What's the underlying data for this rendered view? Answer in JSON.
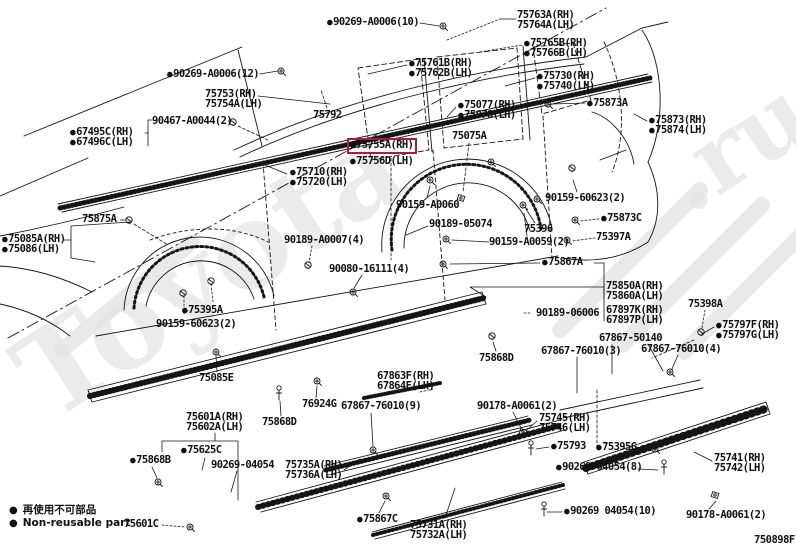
{
  "figure_code": "750898F",
  "colors": {
    "accent_highlight_box": "#a81c3c",
    "line_art": "#151515",
    "watermark": "#e0e0e0"
  },
  "icons": {
    "bullet": "●"
  },
  "watermark": {
    "brand": "Toyota",
    "suffix": ".ru"
  },
  "legend": {
    "jp": "再使用不可部品",
    "en": "Non-reusable part"
  },
  "highlighted_part": "75755A(RH)",
  "labels": [
    {
      "t": "90269-A0006(10)",
      "x": 327,
      "y": 17,
      "b": true
    },
    {
      "t": "90269-A0006(12)",
      "x": 167,
      "y": 69,
      "b": true
    },
    {
      "t": "75753(RH)",
      "x": 205,
      "y": 89,
      "b": false
    },
    {
      "t": "75754A(LH)",
      "x": 205,
      "y": 99,
      "b": false
    },
    {
      "t": "90467-A0044(2)",
      "x": 152,
      "y": 116,
      "b": false
    },
    {
      "t": "67495C(RH)",
      "x": 70,
      "y": 127,
      "b": true
    },
    {
      "t": "67496C(LH)",
      "x": 70,
      "y": 137,
      "b": true
    },
    {
      "t": "75763A(RH)",
      "x": 517,
      "y": 10,
      "b": false
    },
    {
      "t": "75764A(LH)",
      "x": 517,
      "y": 20,
      "b": false
    },
    {
      "t": "75765B(RH)",
      "x": 524,
      "y": 38,
      "b": true
    },
    {
      "t": "75766B(LH)",
      "x": 524,
      "y": 48,
      "b": true
    },
    {
      "t": "75761B(RH)",
      "x": 409,
      "y": 58,
      "b": true
    },
    {
      "t": "75762B(LH)",
      "x": 409,
      "y": 68,
      "b": true
    },
    {
      "t": "75730(RH)",
      "x": 537,
      "y": 71,
      "b": true
    },
    {
      "t": "75740(LH)",
      "x": 537,
      "y": 81,
      "b": true
    },
    {
      "t": "75873A",
      "x": 587,
      "y": 98,
      "b": true
    },
    {
      "t": "75873(RH)",
      "x": 649,
      "y": 115,
      "b": true
    },
    {
      "t": "75874(LH)",
      "x": 649,
      "y": 125,
      "b": true
    },
    {
      "t": "75077(RH)",
      "x": 458,
      "y": 100,
      "b": true
    },
    {
      "t": "75078(LH)",
      "x": 458,
      "y": 110,
      "b": true
    },
    {
      "t": "75792",
      "x": 313,
      "y": 110,
      "b": false
    },
    {
      "t": "75075A",
      "x": 452,
      "y": 131,
      "b": false
    },
    {
      "t": "75755A(RH)",
      "x": 347,
      "y": 138,
      "b": true,
      "hl": true
    },
    {
      "t": "75756D(LH)",
      "x": 350,
      "y": 156,
      "b": true
    },
    {
      "t": "75710(RH)",
      "x": 290,
      "y": 167,
      "b": true
    },
    {
      "t": "75720(LH)",
      "x": 290,
      "y": 177,
      "b": true
    },
    {
      "t": "90159-A0060",
      "x": 396,
      "y": 200,
      "b": false
    },
    {
      "t": "90189-05074",
      "x": 429,
      "y": 219,
      "b": false
    },
    {
      "t": "75396",
      "x": 524,
      "y": 224,
      "b": false
    },
    {
      "t": "90159-A0059(2)",
      "x": 489,
      "y": 237,
      "b": false
    },
    {
      "t": "90159-60623(2)",
      "x": 545,
      "y": 193,
      "b": false
    },
    {
      "t": "75873C",
      "x": 601,
      "y": 213,
      "b": true
    },
    {
      "t": "75397A",
      "x": 596,
      "y": 232,
      "b": false
    },
    {
      "t": "75867A",
      "x": 542,
      "y": 257,
      "b": true
    },
    {
      "t": "90189-A0007(4)",
      "x": 284,
      "y": 235,
      "b": false
    },
    {
      "t": "90080-16111(4)",
      "x": 329,
      "y": 264,
      "b": false
    },
    {
      "t": "75875A",
      "x": 82,
      "y": 214,
      "b": false
    },
    {
      "t": "75085A(RH)",
      "x": 2,
      "y": 234,
      "b": true
    },
    {
      "t": "75086(LH)",
      "x": 2,
      "y": 244,
      "b": true
    },
    {
      "t": "75395A",
      "x": 182,
      "y": 305,
      "b": true
    },
    {
      "t": "90159-60623(2)",
      "x": 156,
      "y": 319,
      "b": false
    },
    {
      "t": "75085E",
      "x": 199,
      "y": 373,
      "b": false
    },
    {
      "t": "75850A(RH)",
      "x": 606,
      "y": 281,
      "b": false
    },
    {
      "t": "75860A(LH)",
      "x": 606,
      "y": 291,
      "b": false
    },
    {
      "t": "90189-06006",
      "x": 536,
      "y": 308,
      "b": false
    },
    {
      "t": "67897K(RH)",
      "x": 606,
      "y": 305,
      "b": false
    },
    {
      "t": "67897P(LH)",
      "x": 606,
      "y": 315,
      "b": false
    },
    {
      "t": "75398A",
      "x": 688,
      "y": 299,
      "b": false
    },
    {
      "t": "75797F(RH)",
      "x": 716,
      "y": 320,
      "b": true
    },
    {
      "t": "75797G(LH)",
      "x": 716,
      "y": 330,
      "b": true
    },
    {
      "t": "67867-50140",
      "x": 599,
      "y": 333,
      "b": false
    },
    {
      "t": "67867-76010(3)",
      "x": 541,
      "y": 346,
      "b": false
    },
    {
      "t": "67867-76010(4)",
      "x": 641,
      "y": 344,
      "b": false
    },
    {
      "t": "75868D",
      "x": 479,
      "y": 353,
      "b": false
    },
    {
      "t": "67863F(RH)",
      "x": 377,
      "y": 371,
      "b": false
    },
    {
      "t": "67864F(LH)",
      "x": 377,
      "y": 381,
      "b": false
    },
    {
      "t": "76924G",
      "x": 302,
      "y": 399,
      "b": false
    },
    {
      "t": "67867-76010(9)",
      "x": 341,
      "y": 401,
      "b": false
    },
    {
      "t": "90178-A0061(2)",
      "x": 477,
      "y": 401,
      "b": false
    },
    {
      "t": "75868D",
      "x": 262,
      "y": 417,
      "b": false
    },
    {
      "t": "75601A(RH)",
      "x": 186,
      "y": 412,
      "b": false
    },
    {
      "t": "75602A(LH)",
      "x": 186,
      "y": 422,
      "b": false
    },
    {
      "t": "75625C",
      "x": 181,
      "y": 445,
      "b": true
    },
    {
      "t": "75868B",
      "x": 130,
      "y": 455,
      "b": true
    },
    {
      "t": "90269-04054",
      "x": 211,
      "y": 460,
      "b": false
    },
    {
      "t": "75735A(RH)",
      "x": 285,
      "y": 460,
      "b": false
    },
    {
      "t": "75736A(LH)",
      "x": 285,
      "y": 470,
      "b": false
    },
    {
      "t": "75867C",
      "x": 357,
      "y": 514,
      "b": true
    },
    {
      "t": "75731A(RH)",
      "x": 410,
      "y": 520,
      "b": false
    },
    {
      "t": "75732A(LH)",
      "x": 410,
      "y": 530,
      "b": false
    },
    {
      "t": "75745(RH)",
      "x": 539,
      "y": 413,
      "b": false
    },
    {
      "t": "75746(LH)",
      "x": 539,
      "y": 423,
      "b": false
    },
    {
      "t": "75793",
      "x": 551,
      "y": 441,
      "b": true
    },
    {
      "t": "75395G",
      "x": 596,
      "y": 442,
      "b": true
    },
    {
      "t": "90269-04054(8)",
      "x": 556,
      "y": 462,
      "b": true
    },
    {
      "t": "75741(RH)",
      "x": 714,
      "y": 453,
      "b": false
    },
    {
      "t": "75742(LH)",
      "x": 714,
      "y": 463,
      "b": false
    },
    {
      "t": "90269 04054(10)",
      "x": 564,
      "y": 506,
      "b": true
    },
    {
      "t": "90178-A0061(2)",
      "x": 686,
      "y": 510,
      "b": false
    },
    {
      "t": "75601C",
      "x": 124,
      "y": 519,
      "b": false
    }
  ]
}
